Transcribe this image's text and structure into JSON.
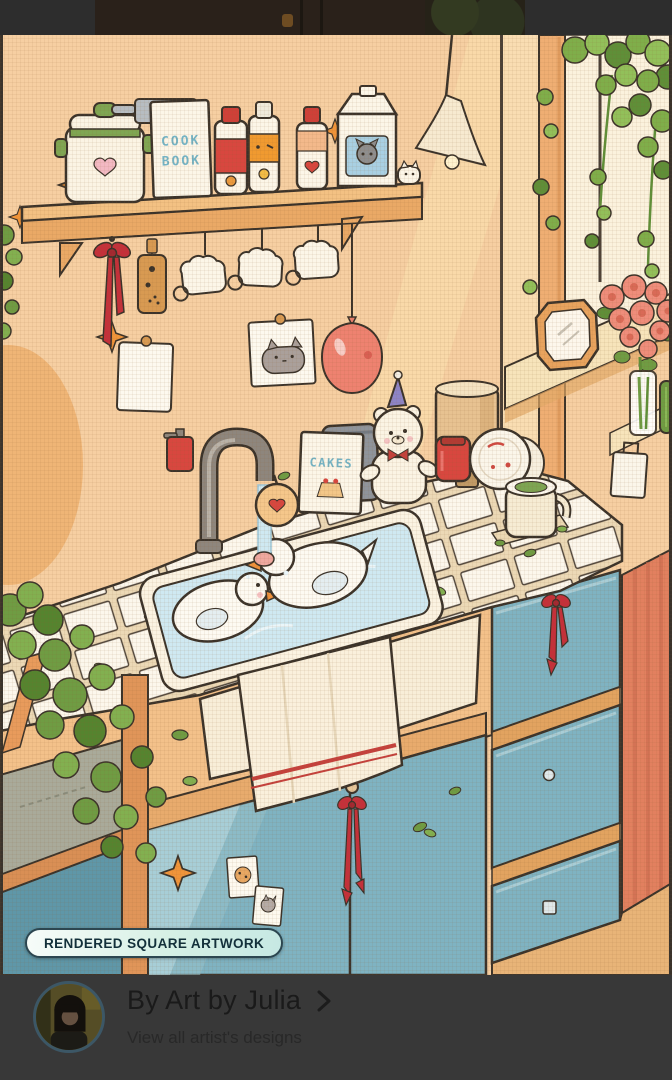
{
  "badge": {
    "label": "RENDERED SQUARE ARTWORK"
  },
  "artist": {
    "byline": "By Art by Julia",
    "subtitle": "View all artist's designs"
  },
  "artwork": {
    "cook_book_line1": "COOK",
    "cook_book_line2": "BOOK",
    "cakes_label": "CAKES"
  },
  "colors": {
    "wall_peach": "#f6cfa2",
    "cabinet_teal": "#7fb3c2",
    "ribbon_red": "#c5303a",
    "wood_orange": "#e8ab6d",
    "water_blue": "#cfe9f2",
    "badge_bg": "#d6f0e5",
    "badge_text": "#13303a",
    "panel_bg": "#383838",
    "accent_red_wall": "#e2805f",
    "leaf_green": "#6f9c43"
  }
}
